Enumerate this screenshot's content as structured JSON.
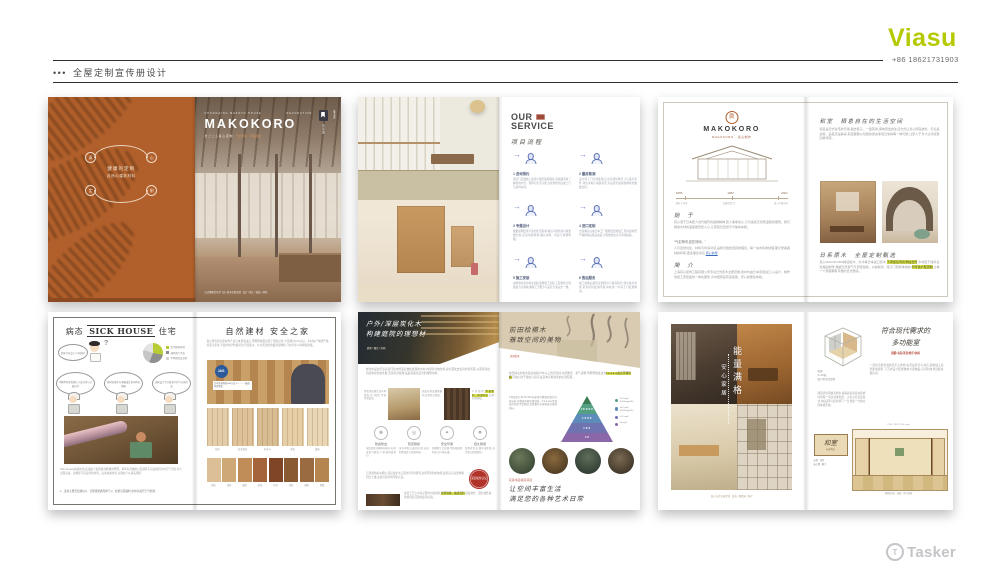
{
  "header": {
    "dots": "•••",
    "title": "全屋定制宣传册设计"
  },
  "brand": {
    "name": "Viasu",
    "phone": "+86 18621731903",
    "color": "#b5c900"
  },
  "watermark": {
    "label": "Tasker",
    "icon": "T"
  },
  "icons": {
    "arrow": "→",
    "question": "?"
  },
  "cover": {
    "badge": {
      "arc_label": "MAKOKORO",
      "line1": "健康的定制",
      "line2": "自然の建筑材料",
      "circles": [
        "真",
        "心",
        "定",
        "制"
      ]
    },
    "eyebrow_left": "CHONGQING MAKOTO HOUSE",
    "eyebrow_right": "DECORATION",
    "title": "MAKOKORO",
    "subtitle_l": "ま ご こ ろ 真 心 定 制",
    "subtitle_r": "日式原木 · 环保建材",
    "tag_vertical": "真心定制",
    "side_vertical": "株式会社",
    "footer": "日式健康住宅专门店 | 原木全屋定制 · 设计 / 施工 / 软装一体化"
  },
  "service": {
    "title1": "OUR",
    "title2": "SERVICE",
    "script": "项目流程",
    "steps": [
      {
        "label": "1 咨询预约",
        "desc": "通过门店或线上渠道与我们取得联系,专属顾问将了解您的户型、预算与生活习惯,为您预约到店或上门洽谈的时间。"
      },
      {
        "label": "2 量房勘测",
        "desc": "设计师上门实地勘测,记录房屋结构尺寸与采光条件,评估水电与墙面状况,为后续方案提供精准的数据支持。"
      },
      {
        "label": "3 专属设计",
        "desc": "根据勘测结果与您的生活需求,输出平面布局与效果图方案,反复沟通调整,确认材料、色彩与预算明细。"
      },
      {
        "label": "4 进口定制",
        "desc": "方案确认后由日本工厂按图纸定制加工,原木建材经严格检验后报关发运,全程物流信息可查询追踪。"
      },
      {
        "label": "5 施工安装",
        "desc": "由经验丰富的专业团队进场施工安装,工程管家全程跟进节点验收,确保工艺细节与设计方案完全一致。"
      },
      {
        "label": "6 售后服务",
        "desc": "竣工验收后提供定期回访与保养指导,建立客户档案,若有任何使用问题,将在第一时间上门处理解决。"
      }
    ]
  },
  "brandpage": {
    "logo_glyph": "眞",
    "title": "MAKOKORO",
    "subtitle": "MAGOKORO · 真心制作",
    "timeline": [
      {
        "year": "1955",
        "label": "创业于日本"
      },
      {
        "year": "1987",
        "label": "自建定制工厂"
      },
      {
        "year": "2021",
        "label": "进入中国市场"
      }
    ],
    "h1": "始 于",
    "p1": "真心源于日本匠人世代相传的造物精神,匠人秉承初心,只为造就天然而温暖的居所。我们相信木材的温度能安抚人心,让家回归自然与宁静的本质。",
    "quote": "“气定神闲,如在林间。”",
    "p2": "人与自然共生、材料与时间对话,是我们始终坚持的理念。每一块木料的纹理,都记录着森林的呼吸,更多理念请见",
    "link": "真心的家",
    "h2": "简 介",
    "p3": "上海真心装饰工程有限公司专注日式原木全屋定制,建材均由日本原装进口,从设计、制作到施工安装提供一体化服务,为中国家庭带来健康、安心的居住体验。"
  },
  "washitsu": {
    "h1": "和室　栖息自在的生活空间",
    "p1": "和室是日式住宅的灵魂,脱去鞋子、一盏茶香,席地而坐的生活方式让身心彻底放松。无论是会客、品茗还是静读,和室都能以包容的姿态承载日常的每一种可能,让家人于方寸之间感受四季流转。",
    "h2": "日系原木　全屋定制甄选",
    "p2a": "真心MAKOKORO精选桧木、杉木等日本进口原木,",
    "hl1": "不添加任何化学粘合剂",
    "p2b": ",木材经干燥养生处理后制作,保留天然香气与调湿性能。从榻榻米、障子门到整体收纳,",
    "hl2": "均可依户型定制",
    "p2c": ",让每一个家都拥有专属的日式质感。"
  },
  "sickhouse": {
    "title_pre": "病态",
    "title_en": "SICK HOUSE",
    "title_post": "住宅",
    "bubble": "新家为何会让人不舒服?",
    "legend": [
      "化学建材影响",
      "通风换气不良",
      "不明原因及其他"
    ],
    "workers": [
      "甲醛等挥发物超标,引发头晕与过敏症状",
      "建材防潮不当,霉菌滋生影响呼吸健康",
      "通风设计不合理,室内空气长期浑浊"
    ],
    "caption": "Sick House(病态住宅)是指由于装修建材释放的甲醛、苯等有害物质以及通风不良造成的室内空气污染,令人出现头痛、过敏等不适症状的住宅。远离病态住宅,关键在于从源头把控:",
    "list": "1、选用无醛天然建材;2、合理规划通风换气;3、杜绝劣质辅料,交付前进行空气检测。"
  },
  "materials": {
    "title": "自然建材 安全之家",
    "intro": "真心所有原木建材均产自日本原装进口,甲醛释放量远低于国家标准,全部通过JAS认证。木材在产地经严格筛选与养生,不使用化学防腐药剂,凭借桧木、杉木天然的抗菌调湿特性,守护全家人的呼吸健康。",
    "stamp": "JAS",
    "stamp_caption": "日本农林规格JAS认证 F☆☆☆☆最高环保等级",
    "light": [
      {
        "label": "桧木",
        "c": "#e3cda8"
      },
      {
        "label": "杉木直纹",
        "c": "#ddc29a"
      },
      {
        "label": "杉木节",
        "c": "#d8bd92"
      },
      {
        "label": "赤松",
        "c": "#e6cfa6"
      },
      {
        "label": "椴木",
        "c": "#e9d6b4"
      }
    ],
    "dark": [
      {
        "label": "原色",
        "c": "#dcbf96"
      },
      {
        "label": "浅茶",
        "c": "#cfa878"
      },
      {
        "label": "黄茶",
        "c": "#c08c57"
      },
      {
        "label": "茶色",
        "c": "#a5643a"
      },
      {
        "label": "红棕",
        "c": "#7e4526"
      },
      {
        "label": "深棕",
        "c": "#8a5a33"
      },
      {
        "label": "胡桃",
        "c": "#9a6b41"
      },
      {
        "label": "黑檀",
        "c": "#b5854f"
      }
    ]
  },
  "charcoal": {
    "title1": "户外/深层炭化木",
    "title2": "构建庭院的理想材",
    "tag": "庭院 / 露台 / 外构",
    "p1": "炭化木是在无氧高温环境中经深层炭化处理的木材,内部养分被分解,腐朽菌失去生存的营养源,从而获得出色的防腐防虫性能,无需药剂处理,是庭院露台造景的理想用材。",
    "note1": "经炭化处理后含水率更低,尺寸稳定,不易开裂变形。",
    "note_mid": "表面呈现深邃焦糖色,自带复古质感。",
    "note2a": "户外使用,",
    "note2_hl": "不易腐朽、防虫防蛀",
    "note2b": ",后期打理轻松。",
    "features": [
      {
        "icon": "❋",
        "label": "防腐防虫",
        "desc": "深层炭化分解木材养分,杜绝虫蛀与腐朽,户外使用更放心。"
      },
      {
        "icon": "◎",
        "label": "稳定耐候",
        "desc": "含水率低,抗变形开裂,适应四季温差与雨雪环境。"
      },
      {
        "icon": "✦",
        "label": "安全环保",
        "desc": "纯物理工艺处理,不添加防腐药剂,对人体无害。"
      },
      {
        "icon": "❖",
        "label": "经久耐用",
        "desc": "使用寿命长,维护成本低,岁月愈久质感愈佳。"
      }
    ],
    "p2": "与普通防腐木相比,深层炭化木无需化学药剂即可达到同等防护效果,废弃后可自然降解回归土壤,是更可持续的环保之选。",
    "badge": "深层炭化认证",
    "p3a": "炭化工艺让木材呈现均匀深咖色,",
    "p3_hl": "纹理清晰、触感温润",
    "p3b": ",铺设地台、围栏或外墙,皆能营造沉稳的庭院氛围。"
  },
  "hinoki": {
    "title1": "前田桧槅木",
    "title2": "雅致空间的美物",
    "tag": "天然桧木",
    "p1a": "前田林业的桧木取自树龄70年以上的天然林,木质致密、香气清雅,甲醛释放量达到",
    "p1_hl": "F★★★★最高环保等级",
    "p1b": ",可放心用于婴幼儿房间,是日本高端住宅的标准配置。",
    "p2": "F等级是日本JIS/JAS对建材甲醛释放量的分级标准,星数越多释放量越低。F★★★★等级使用面积不受限制,是衡量住宅健康度的重要指标。",
    "pyramid": [
      {
        "label": "",
        "c": "#3c7a52"
      },
      {
        "label": "F★★★★",
        "c": "#55a083",
        "note": "≤0.3 mg/L (0.005mg/m²h)"
      },
      {
        "label": "F★★★",
        "c": "#5e8cba",
        "note": "≤0.5 mg/L (0.020mg/m²h)"
      },
      {
        "label": "F★★",
        "c": "#6f74b0",
        "note": "≤1.5 mg/L"
      },
      {
        "label": "F★",
        "c": "#8a67a8",
        "note": "≤5 mg/L"
      }
    ],
    "arts": "花道/书道/香道/茶道",
    "slogan1": "让空间丰富生活",
    "slogan2": "满足您的各种艺术日常"
  },
  "energy": {
    "vert_main": "能量满格",
    "vert_sub": "安心家居",
    "caption": "真心日式全屋定制 · 桧木 / 榻榻米 / 障子"
  },
  "multiroom": {
    "title1": "符合现代需求的",
    "title2": "多功能室",
    "subtitle": "团聚/书房/茶室/娱乐/休闲",
    "iso_note1": "和室",
    "iso_note2": "3~4.5帖",
    "iso_note3": "依户型灵活定制",
    "p1": "一间和室能承载的远不止休憩:白天是茶室与书房,夜晚铺上床垫即成客卧,下沉式设计还能收纳大量物品,空间利用率远超常规房间。",
    "p2": "随着居住需求多样化,越来越多家庭在装修时预留一间多功能和室。无论平层还是复式,3帖起即可定制,移门一合,便是一方独立的静谧天地。",
    "elev_label": "和室",
    "elev_sub": "标准构成",
    "dims_top": "2730 / 1820 / 910 (mm)",
    "note_left1": "天袋 · 吊柜",
    "note_left2": "床の間 / 障子",
    "dims_bottom": "榻榻米3帖 · 床脇 · 押入收纳"
  }
}
